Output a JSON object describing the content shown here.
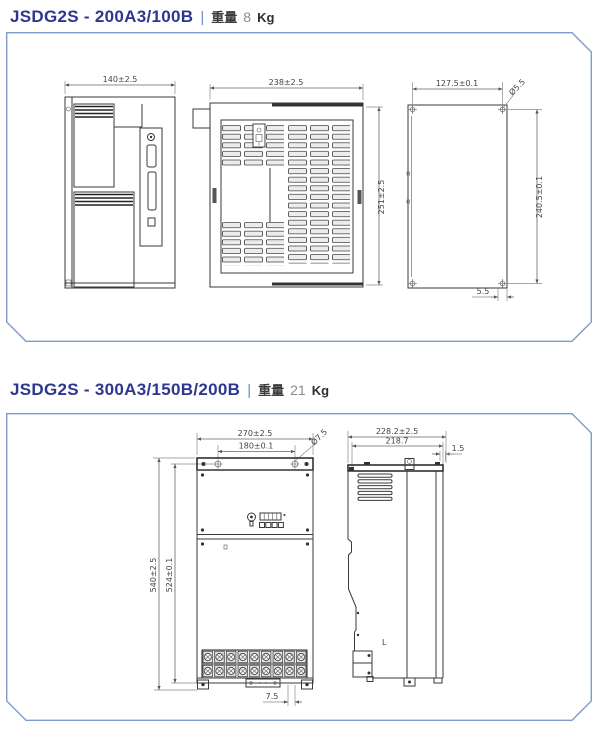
{
  "page": {
    "background": "#ffffff",
    "panel_border_color": "#7e9bcb",
    "title_color": "#2c3790"
  },
  "sections": [
    {
      "model": "JSDG2S - 200A3/100B",
      "separator": "|",
      "weight_label": "重量",
      "weight_number": "8",
      "weight_unit": "Kg",
      "views": {
        "side": {
          "width": "140±2.5"
        },
        "front": {
          "width": "238±2.5",
          "height": "251±2.5"
        },
        "back": {
          "hole_pitch_width": "127.5±0.1",
          "hole_diameter": "Ø5.5",
          "hole_pitch_height": "240.5±0.1",
          "hole_offset": "5.5"
        }
      }
    },
    {
      "model": "JSDG2S - 300A3/150B/200B",
      "separator": "|",
      "weight_label": "重量",
      "weight_number": "21",
      "weight_unit": "Kg",
      "views": {
        "front": {
          "width": "270±2.5",
          "hole_pitch_width": "180±0.1",
          "hole_diameter": "Ø7.5",
          "height": "540±2.5",
          "hole_pitch_height": "524±0.1",
          "hole_offset": "7.5"
        },
        "side": {
          "depth": "228.2±2.5",
          "inner_depth": "218.7",
          "lip": "1.5",
          "marking": "L"
        }
      }
    }
  ]
}
